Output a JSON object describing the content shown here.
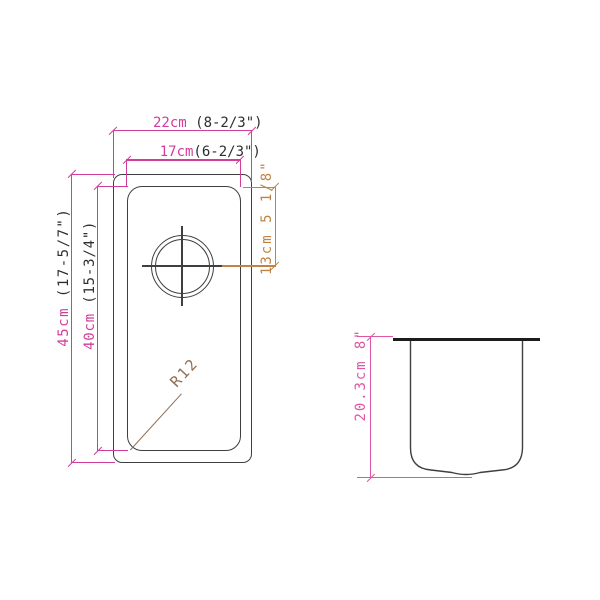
{
  "drawing": {
    "type": "sink-specification",
    "views": {
      "plan": "top view with drain hole",
      "section": "side depth view"
    }
  },
  "dims": {
    "outer_width": {
      "metric": "22cm",
      "imperial": " (8-2/3\")"
    },
    "inner_width": {
      "metric": "17cm",
      "imperial": "(6-2/3\")"
    },
    "outer_length": {
      "metric": "45cm",
      "imperial": " (17-5/7\")"
    },
    "inner_length": {
      "metric": "40cm",
      "imperial": " (15-3/4\")"
    },
    "drain_offset": {
      "metric": "13cm",
      "imperial": " 5 1/8\""
    },
    "depth": {
      "metric": "20.3cm",
      "imperial": " 8\""
    },
    "corner_radius": "R12"
  },
  "colors": {
    "dimension_magenta": "#d23c9b",
    "dimension_pink": "#de55a5",
    "dimension_orange": "#bf8443",
    "radius_brown": "#8f6e54",
    "outline": "#3f3f3f",
    "counter_black": "#1c1c1c",
    "text_dark": "#2e2e2e",
    "background": "#ffffff"
  }
}
